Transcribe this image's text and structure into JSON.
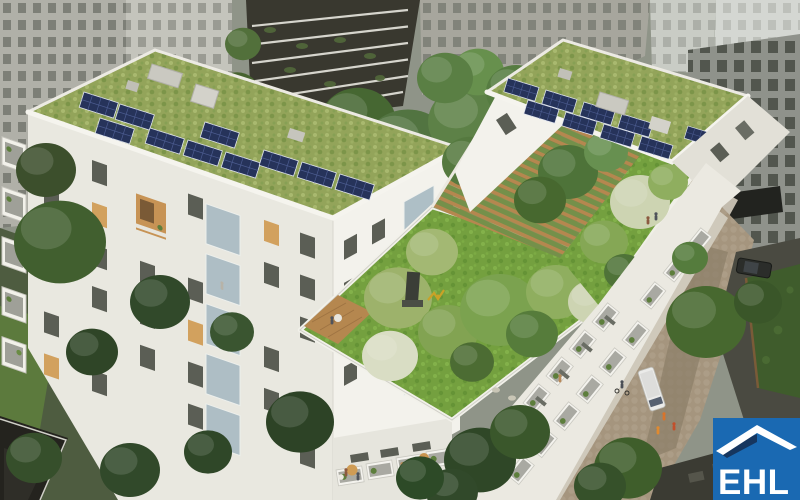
{
  "image": {
    "description": "Aerial architectural rendering of two white residential buildings with sedum green roofs, rooftop solar panels, a landscaped courtyard roof garden with pergola and sculpture, surrounded by gray city office buildings, streets with trees, a delivery van and pedestrians; EHL logo in the lower right corner"
  },
  "logo": {
    "text": "EHL",
    "icon": "house-roof-icon"
  },
  "scene": {
    "left_building": "white residential building with sedum roof and photovoltaic panels",
    "right_building": "white residential building with rooftop pergola garden and photovoltaic panels",
    "courtyard_garden": "rooftop courtyard garden with lawn, trees, wooden deck and sculptures",
    "background": "surrounding gray office buildings and terraced building",
    "street": "street with delivery van, parked car, cyclists and pedestrians"
  },
  "palette": {
    "brand_blue": "#1a69b2",
    "brand_navy": "#16365f",
    "logo_white": "#ffffff",
    "building_white": "#f3f2ec",
    "building_shade": "#e9e8e0",
    "facade_dim": "#e2e0d7",
    "sedum_green": "#93a45a",
    "lawn_green": "#74a03f",
    "solar_navy": "#26335a",
    "tree_green": "#4c7037",
    "tree_dark": "#31492a",
    "blossom": "#cdd4b2",
    "office_gray": "#b0b0a8",
    "office_mid": "#a7a69d",
    "office_light": "#c9ccc5",
    "tower_gray": "#8f928b",
    "window_dark": "#5b5e55",
    "terraced_dark": "#39382f",
    "street_tan": "#a5957e",
    "sidewalk": "#cfc9bb",
    "pavement_dark": "#67675c",
    "grass_dark": "#4e5c40",
    "wood_brown": "#b5874f",
    "hedge_green": "#3f5c2c",
    "glass_blue": "#a9bbc3",
    "lit_window": "#d2a15e",
    "van_white": "#ebebe9"
  }
}
